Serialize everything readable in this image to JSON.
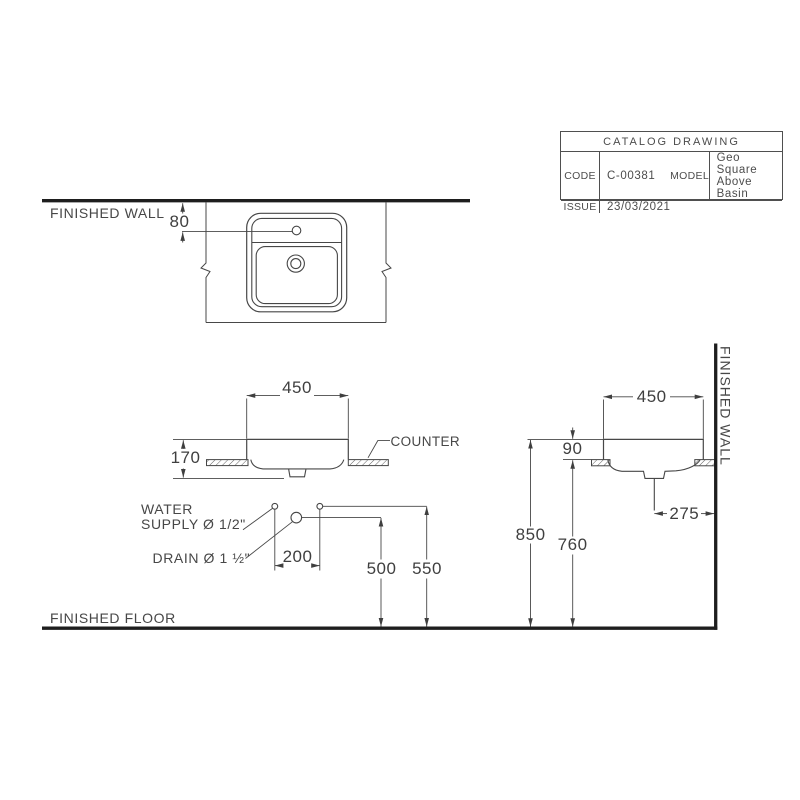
{
  "title_block": {
    "title": "CATALOG DRAWING",
    "rows": [
      {
        "label": "CODE",
        "value": "C-00381"
      },
      {
        "label": "MODEL",
        "value": "Geo Square Above Basin"
      },
      {
        "label": "ISSUE",
        "value": "23/03/2021"
      }
    ]
  },
  "labels": {
    "finished_wall_top": "FINISHED WALL",
    "finished_wall_right": "FINISHED WALL",
    "finished_floor": "FINISHED FLOOR",
    "counter": "COUNTER",
    "water_supply_line1": "WATER",
    "water_supply_line2": "SUPPLY Ø 1/2\"",
    "drain": "DRAIN Ø 1 ½\""
  },
  "dimensions": {
    "wall_to_faucet": "80",
    "basin_width": "450",
    "basin_depth_side": "450",
    "basin_height": "170",
    "rim_above_counter": "90",
    "supply_spacing": "200",
    "drain_height": "500",
    "supply_height": "550",
    "drain_to_wall": "275",
    "rim_from_floor": "850",
    "counter_height": "760"
  },
  "colors": {
    "line": "#474747",
    "thick_line": "#1e1e1e",
    "text": "#4a4a4a",
    "background": "#ffffff"
  }
}
